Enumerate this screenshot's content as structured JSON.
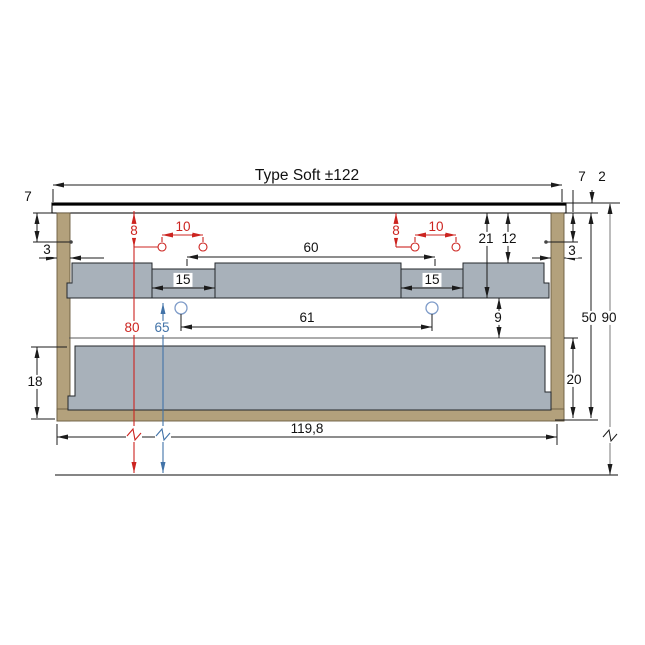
{
  "title": "Type Soft ±122",
  "colors": {
    "ink": "#1b1b1b",
    "red": "#cc2420",
    "blue": "#4273a8",
    "blue_light": "#7f9cc9",
    "tan": "#b3a17c",
    "gray": "#a8b1ba"
  },
  "labels": {
    "type_title": "Type Soft ±122",
    "left_7": "7",
    "left_3": "3",
    "red_8_left": "8",
    "red_10_left": "10",
    "dim_60": "60",
    "red_8_right": "8",
    "red_10_right": "10",
    "dim_21": "21",
    "dim_12": "12",
    "right_7": "7",
    "right_2": "2",
    "right_3": "3",
    "slot_15_left": "15",
    "slot_15_right": "15",
    "dim_61": "61",
    "dim_9": "9",
    "red_80": "80",
    "blue_65": "65",
    "dim_18": "18",
    "dim_20": "20",
    "dim_50": "50",
    "dim_90": "90",
    "bottom_width": "119,8"
  }
}
